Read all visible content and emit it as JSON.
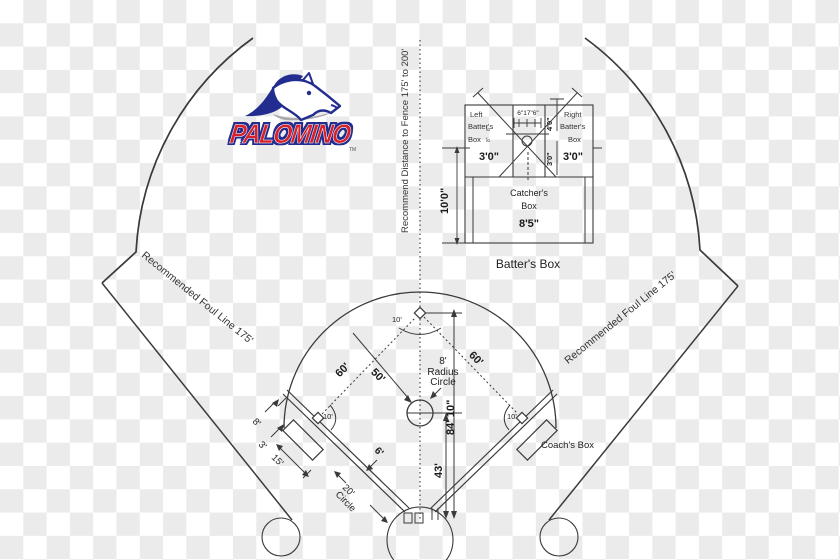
{
  "logo": {
    "name": "PALOMINO",
    "tm": "TM"
  },
  "inset": {
    "title": "Batter's Box",
    "left_box": [
      "Left",
      "Batter's",
      "Box"
    ],
    "right_box": [
      "Right",
      "Batter's",
      "Box"
    ],
    "catcher": [
      "Catcher's",
      "Box"
    ],
    "plate_widths": "6\"17\"6\"",
    "dim_4ft": "4'0\"",
    "dim_3ft_center": "3'0\"",
    "dim_3ft_left": "3'0\"",
    "dim_3ft_right": "3'0\"",
    "dim_10ft": "10'0\"",
    "width_8ft5": "8'5\"",
    "plate_side_a": "8\"",
    "plate_side_b": "8\""
  },
  "field": {
    "fence_note": "Recommend Distance to Fence 175' to 200'",
    "foul_line_left": "Recommended Foul Line 175'",
    "foul_line_right": "Recommended Foul Line 175'",
    "baseline_left_60": "60'",
    "baseline_right_60": "60'",
    "dist_50": "50'",
    "radius_circle": [
      "8'",
      "Radius",
      "Circle"
    ],
    "home_to_second": "84' 10\"",
    "pitching_43": "43'",
    "lane_6": "6'",
    "arc_10_second": "10'",
    "arc_10_third": "10'",
    "arc_10_first": "10'",
    "ondeck": [
      "20'",
      "Circle"
    ],
    "coach_box": "Coach's Box",
    "dim_8": "8'",
    "dim_3": "3'",
    "dim_15": "15'"
  },
  "colors": {
    "line": "#3a3a3a",
    "logo_red": "#d6202a",
    "logo_navy": "#232d8f",
    "checker": "#ebebeb"
  }
}
